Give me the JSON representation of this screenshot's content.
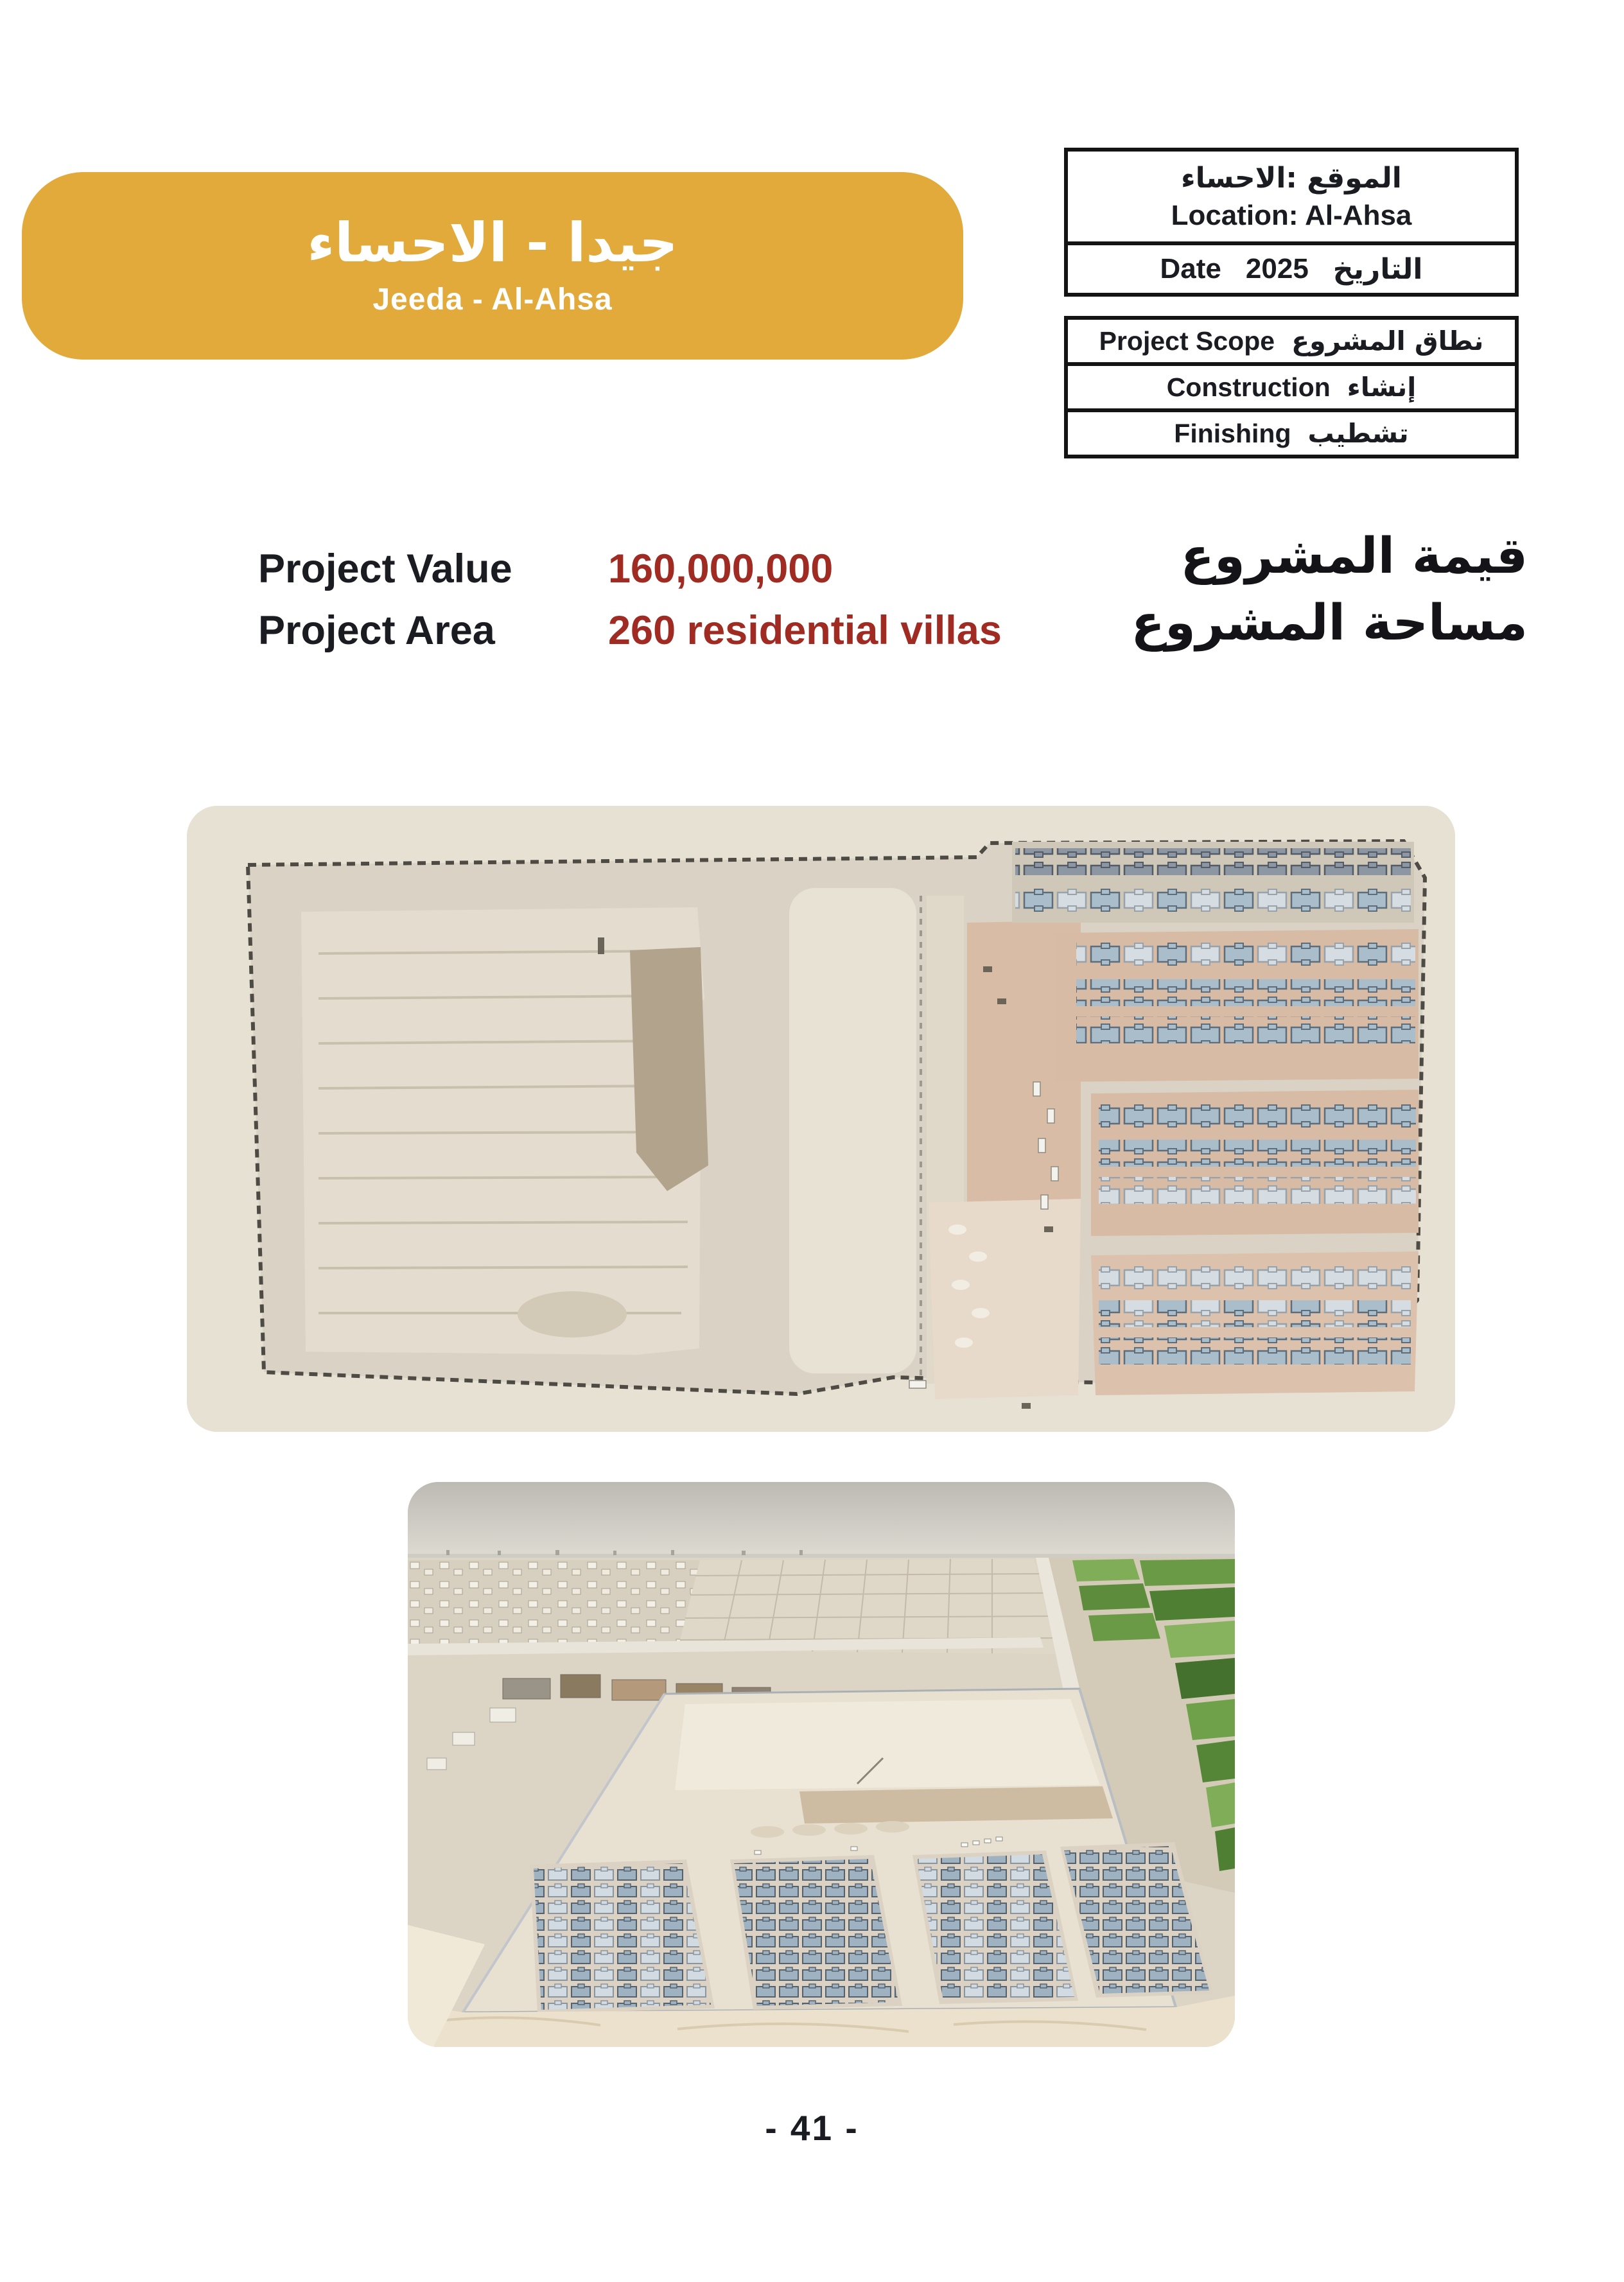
{
  "banner": {
    "title_ar": "جيدا - الاحساء",
    "title_en": "Jeeda - Al-Ahsa"
  },
  "location_box": {
    "location_ar": "الموقع :الاحساء",
    "location_en": "Location: Al-Ahsa",
    "date_en": "Date",
    "date_value": "2025",
    "date_ar": "التاريخ"
  },
  "scope_box": {
    "scope_en": "Project Scope",
    "scope_ar": "نطاق المشروع",
    "construction_en": "Construction",
    "construction_ar": "إنشاء",
    "finishing_en": "Finishing",
    "finishing_ar": "تشطيب"
  },
  "details": {
    "value_label_en": "Project Value",
    "value_amount": "160,000,000",
    "value_label_ar": "قيمة المشروع",
    "area_label_en": "Project Area",
    "area_value": "260 residential villas",
    "area_label_ar": "مساحة المشروع"
  },
  "footer": {
    "page_number": "- 41 -"
  },
  "colors": {
    "banner_bg": "#E2A93B",
    "accent_red": "#A02B23",
    "text_black": "#1B1B22"
  }
}
